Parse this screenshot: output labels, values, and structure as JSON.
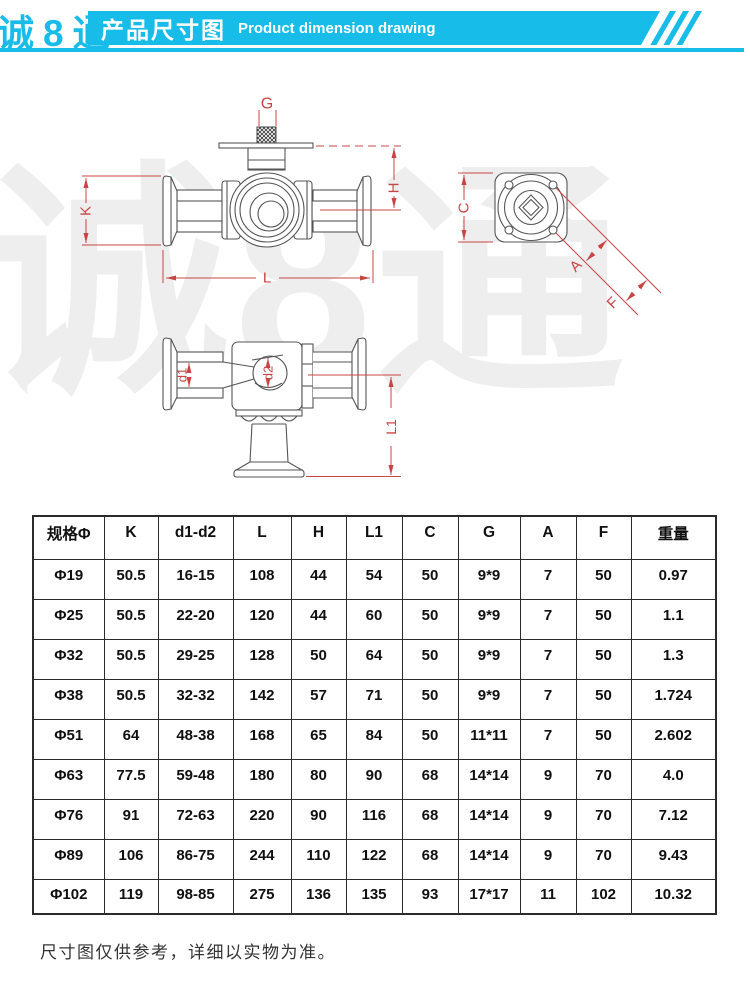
{
  "header": {
    "logo_text": "诚8通",
    "banner_title_zh": "产品尺寸图",
    "banner_title_en": "Product dimension drawing"
  },
  "colors": {
    "accent": "#18bce9",
    "dimension_line": "#c84545"
  },
  "watermark_text": "诚8通",
  "dims": {
    "g": "G",
    "k": "K",
    "h": "H",
    "l": "L",
    "c": "C",
    "a": "A",
    "f": "F",
    "d1": "d1",
    "d2": "d2",
    "l1": "L1"
  },
  "table": {
    "columns": [
      "规格Φ",
      "K",
      "d1-d2",
      "L",
      "H",
      "L1",
      "C",
      "G",
      "A",
      "F",
      "重量"
    ],
    "rows": [
      [
        "Φ19",
        "50.5",
        "16-15",
        "108",
        "44",
        "54",
        "50",
        "9*9",
        "7",
        "50",
        "0.97"
      ],
      [
        "Φ25",
        "50.5",
        "22-20",
        "120",
        "44",
        "60",
        "50",
        "9*9",
        "7",
        "50",
        "1.1"
      ],
      [
        "Φ32",
        "50.5",
        "29-25",
        "128",
        "50",
        "64",
        "50",
        "9*9",
        "7",
        "50",
        "1.3"
      ],
      [
        "Φ38",
        "50.5",
        "32-32",
        "142",
        "57",
        "71",
        "50",
        "9*9",
        "7",
        "50",
        "1.724"
      ],
      [
        "Φ51",
        "64",
        "48-38",
        "168",
        "65",
        "84",
        "50",
        "11*11",
        "7",
        "50",
        "2.602"
      ],
      [
        "Φ63",
        "77.5",
        "59-48",
        "180",
        "80",
        "90",
        "68",
        "14*14",
        "9",
        "70",
        "4.0"
      ],
      [
        "Φ76",
        "91",
        "72-63",
        "220",
        "90",
        "116",
        "68",
        "14*14",
        "9",
        "70",
        "7.12"
      ],
      [
        "Φ89",
        "106",
        "86-75",
        "244",
        "110",
        "122",
        "68",
        "14*14",
        "9",
        "70",
        "9.43"
      ],
      [
        "Φ102",
        "119",
        "98-85",
        "275",
        "136",
        "135",
        "93",
        "17*17",
        "11",
        "102",
        "10.32"
      ]
    ]
  },
  "footer": {
    "note": "尺寸图仅供参考，详细以实物为准。"
  }
}
